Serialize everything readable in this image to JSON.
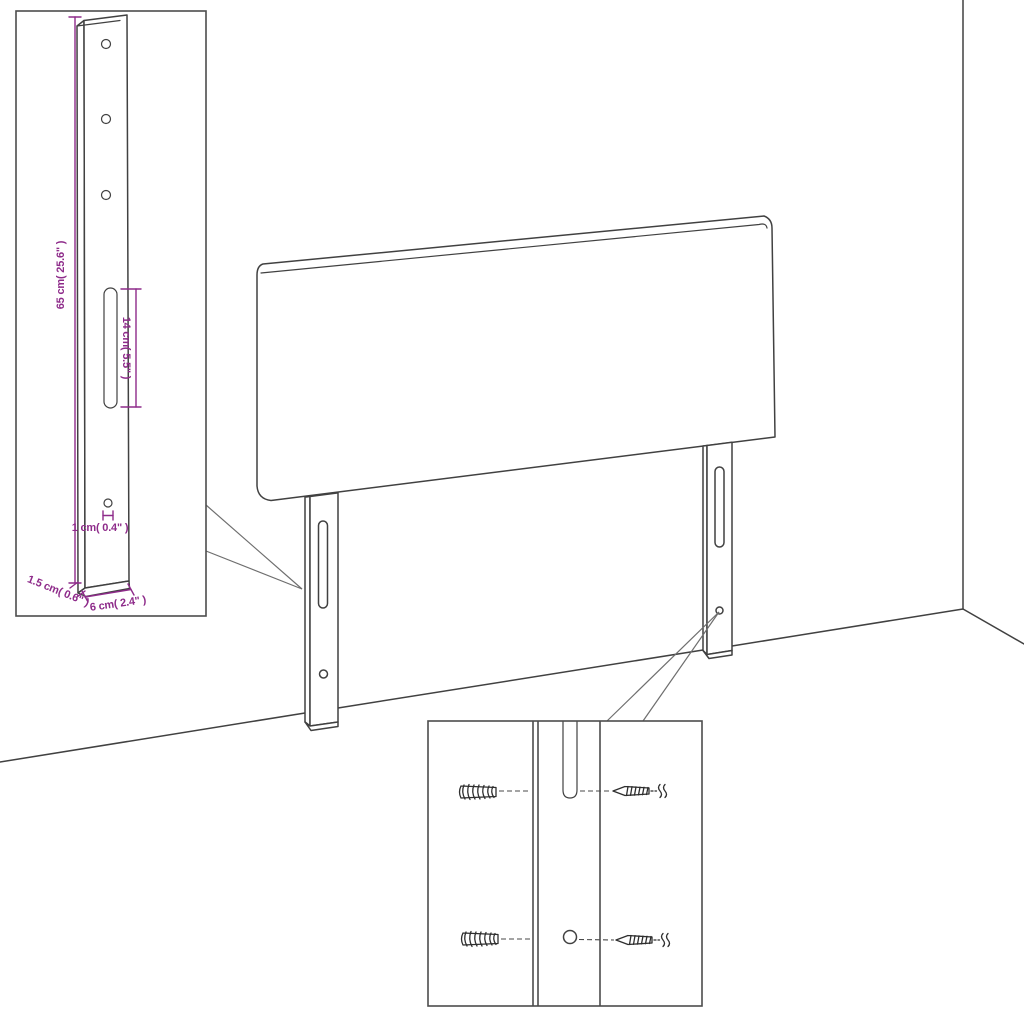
{
  "diagram": {
    "type": "furniture-assembly-dimension-diagram",
    "subject": "upholstered headboard with two wall-mount leg brackets",
    "colors": {
      "line": "#414141",
      "dimension_accent": "#8e2b8a",
      "background": "#ffffff"
    },
    "insets": {
      "bracket_detail": {
        "dimensions": {
          "height": "65 cm( 25.6\" )",
          "slot_length": "14 cm( 5.5\" )",
          "hole_diameter": "1 cm( 0.4\" )",
          "thickness": "1.5 cm( 0.6\" )",
          "width": "6 cm( 2.4\" )"
        }
      },
      "hardware_detail": {
        "parts": [
          "wall-anchor",
          "leg-slot",
          "screw",
          "mounting-hole"
        ]
      }
    }
  }
}
